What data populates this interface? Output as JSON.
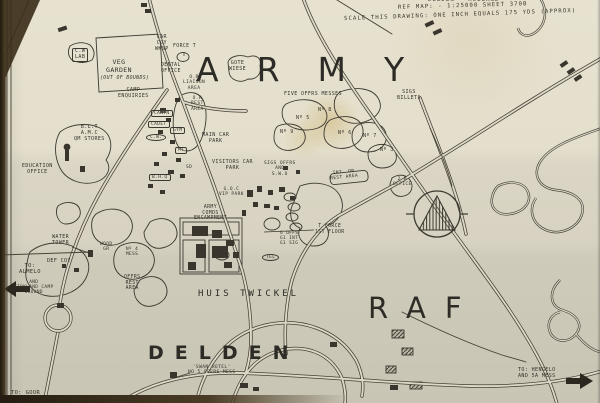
{
  "header": {
    "line1": "DELDEN - HOLLAND",
    "line2": "REF MAP: - 1:25000 SHEET 370B",
    "line3": "SCALE THIS DRAWING: ONE INCH EQUALS 175 YDS (APPROX)"
  },
  "regions": {
    "army": "ARMY",
    "raf": "RAF",
    "town": "DELDEN",
    "house": "HUIS TWICKEL"
  },
  "colors": {
    "ink": "#3a362d",
    "paper": "#dcd7c6",
    "stain": "#bc9634"
  },
  "labels": [
    {
      "t": "C.W\nLAB",
      "x": 72,
      "y": 48,
      "s": 5,
      "box": 1
    },
    {
      "t": "VEG\nGARDEN",
      "x": 106,
      "y": 59,
      "s": 6.5
    },
    {
      "t": "(OUT OF BOUNDS)",
      "x": 100,
      "y": 76,
      "s": 4.8,
      "i": 1
    },
    {
      "t": "CAR\nCOY\nWKSP",
      "x": 155,
      "y": 35,
      "s": 5
    },
    {
      "t": "FORCE T",
      "x": 173,
      "y": 44,
      "s": 4.8
    },
    {
      "t": "DENTAL\nOFFICE",
      "x": 161,
      "y": 63,
      "s": 4.8
    },
    {
      "t": "O.R\nLIAISON\nAREA",
      "x": 183,
      "y": 75,
      "s": 4.6
    },
    {
      "t": "O.R\nREST\nAREA",
      "x": 191,
      "y": 96,
      "s": 4.6
    },
    {
      "t": "CAMP\nENQUIRIES",
      "x": 118,
      "y": 88,
      "s": 5
    },
    {
      "t": "GOTE\nWIESE",
      "x": 229,
      "y": 61,
      "s": 5
    },
    {
      "t": "B.L.T\nA.M.C\nQM STORES",
      "x": 74,
      "y": 125,
      "s": 5
    },
    {
      "t": "EDUCATION\nOFFICE",
      "x": 22,
      "y": 164,
      "s": 5
    },
    {
      "t": "CANTN",
      "x": 151,
      "y": 110,
      "s": 4.5,
      "box": 1
    },
    {
      "t": "CADET",
      "x": 148,
      "y": 121,
      "s": 4.5,
      "box": 1
    },
    {
      "t": "C.W.",
      "x": 146,
      "y": 134,
      "s": 4.5,
      "oval": 1
    },
    {
      "t": "GYM",
      "x": 170,
      "y": 127,
      "s": 4.5,
      "box": 1
    },
    {
      "t": "MT",
      "x": 175,
      "y": 147,
      "s": 4.5,
      "box": 1
    },
    {
      "t": "B.H.Q",
      "x": 149,
      "y": 174,
      "s": 4.5,
      "box": 1
    },
    {
      "t": "SD",
      "x": 186,
      "y": 165,
      "s": 4.5
    },
    {
      "t": "MAIN CAR\nPARK",
      "x": 202,
      "y": 133,
      "s": 5
    },
    {
      "t": "VISITORS CAR\nPARK",
      "x": 212,
      "y": 160,
      "s": 5
    },
    {
      "t": "SIGS OFFRS\nAND\nS.W.O",
      "x": 264,
      "y": 161,
      "s": 4.6
    },
    {
      "t": "FIVE OFFRS MESSES",
      "x": 284,
      "y": 92,
      "s": 5
    },
    {
      "t": "SIGS\nBILLETS",
      "x": 397,
      "y": 90,
      "s": 5
    },
    {
      "t": "Nº 8",
      "x": 318,
      "y": 108,
      "s": 5
    },
    {
      "t": "Nº 5",
      "x": 296,
      "y": 116,
      "s": 5
    },
    {
      "t": "Nº 9",
      "x": 280,
      "y": 130,
      "s": 5
    },
    {
      "t": "Nº 6",
      "x": 338,
      "y": 131,
      "s": 5
    },
    {
      "t": "Nº 7",
      "x": 363,
      "y": 134,
      "s": 5
    },
    {
      "t": "Nº 3",
      "x": 380,
      "y": 148,
      "s": 5
    },
    {
      "t": "INT. OR\nREST AREA",
      "x": 330,
      "y": 170,
      "s": 4.5,
      "r": -6
    },
    {
      "t": "2 B\nOFFICE",
      "x": 393,
      "y": 177,
      "s": 4.5
    },
    {
      "t": "T FORCE\n1ST FLOOR",
      "x": 315,
      "y": 224,
      "s": 4.8
    },
    {
      "t": "ARMY\nCOMDS\nENCAMPMENT",
      "x": 194,
      "y": 205,
      "s": 4.8
    },
    {
      "t": "G.O.C\nVIP PARK",
      "x": 219,
      "y": 187,
      "s": 4.5
    },
    {
      "t": "G OFFS\nG1 INT\nG1 SIG",
      "x": 280,
      "y": 231,
      "s": 4.4
    },
    {
      "t": "TEL",
      "x": 262,
      "y": 254,
      "s": 4.5,
      "oval": 1
    },
    {
      "t": "WATER\nTOWER",
      "x": 52,
      "y": 235,
      "s": 5
    },
    {
      "t": "DEF COY",
      "x": 47,
      "y": 259,
      "s": 5
    },
    {
      "t": "TO:\nALMELO",
      "x": 19,
      "y": 263,
      "s": 5.4
    },
    {
      "t": "AND\nKIRKLAND CAMP\nGROUND",
      "x": 14,
      "y": 280,
      "s": 4.4
    },
    {
      "t": "WOOD\nGR",
      "x": 100,
      "y": 242,
      "s": 4.5
    },
    {
      "t": "Nº 4\nMESS",
      "x": 126,
      "y": 247,
      "s": 4.4
    },
    {
      "t": "OFFRS\nREST\nAREA",
      "x": 124,
      "y": 275,
      "s": 4.8
    },
    {
      "t": "'SWAN HOTEL'\nNO 5 OFFRS MESS",
      "x": 188,
      "y": 365,
      "s": 4.6
    },
    {
      "t": "TO: GOOR",
      "x": 11,
      "y": 390,
      "s": 5.4
    },
    {
      "t": "TO: HENGELO\nAND 5A MESS",
      "x": 518,
      "y": 368,
      "s": 5
    }
  ]
}
